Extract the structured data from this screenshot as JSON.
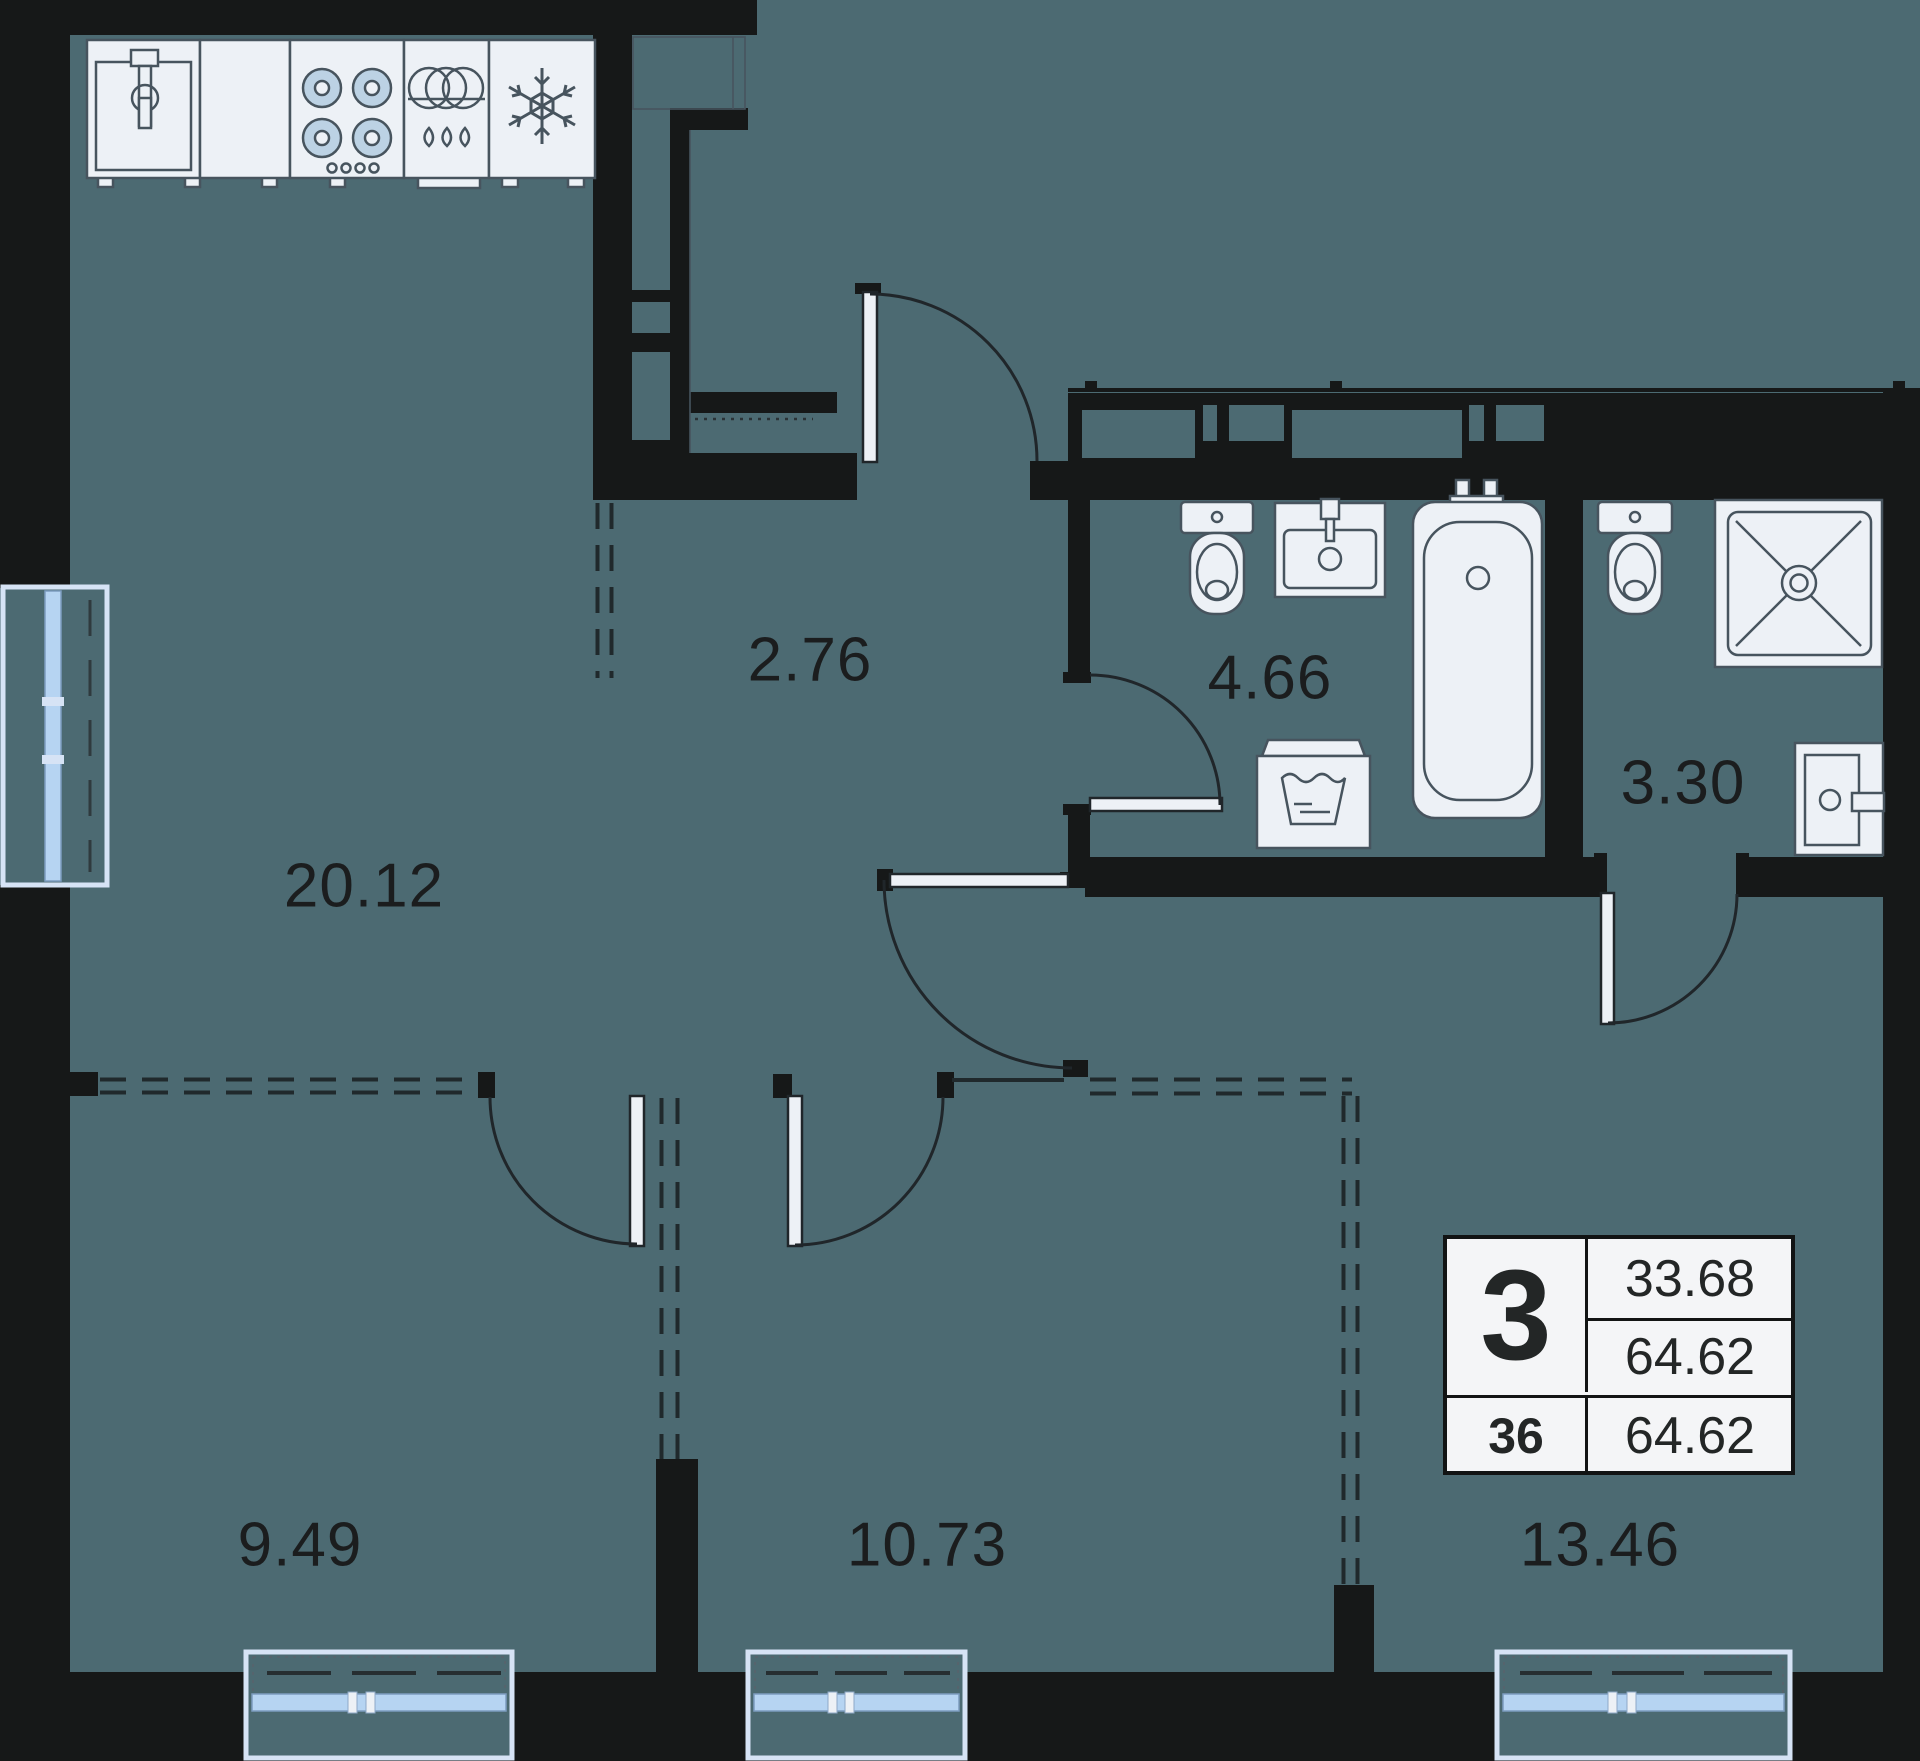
{
  "colors": {
    "outside": "#1d1f1f",
    "wall": "#161818",
    "floor": "#4c6a72",
    "fixture": "#edf1f6",
    "stroke": "#47545e",
    "glass": "#b6d4f2",
    "frame": "#d6e3f5",
    "ink": "#1b1d1e"
  },
  "rooms": [
    {
      "id": "living-kitchen",
      "area": "20.12"
    },
    {
      "id": "hallway",
      "area": "2.76"
    },
    {
      "id": "bathroom",
      "area": "4.66"
    },
    {
      "id": "shower-room",
      "area": "3.30"
    },
    {
      "id": "bedroom-left",
      "area": "9.49"
    },
    {
      "id": "bedroom-middle",
      "area": "10.73"
    },
    {
      "id": "bedroom-right",
      "area": "13.46"
    }
  ],
  "info_box": {
    "rooms_count": "3",
    "living_area": "33.68",
    "total_area": "64.62",
    "unit_number": "36",
    "total_area_repeat": "64.62"
  },
  "icons": [
    "sink-icon",
    "stove-icon",
    "dishwasher-icon",
    "fridge-icon",
    "snowflake-icon",
    "toilet-icon",
    "washbasin-icon",
    "bathtub-icon",
    "washing-machine-icon",
    "shower-icon",
    "entrance-door-icon",
    "window-icon"
  ]
}
